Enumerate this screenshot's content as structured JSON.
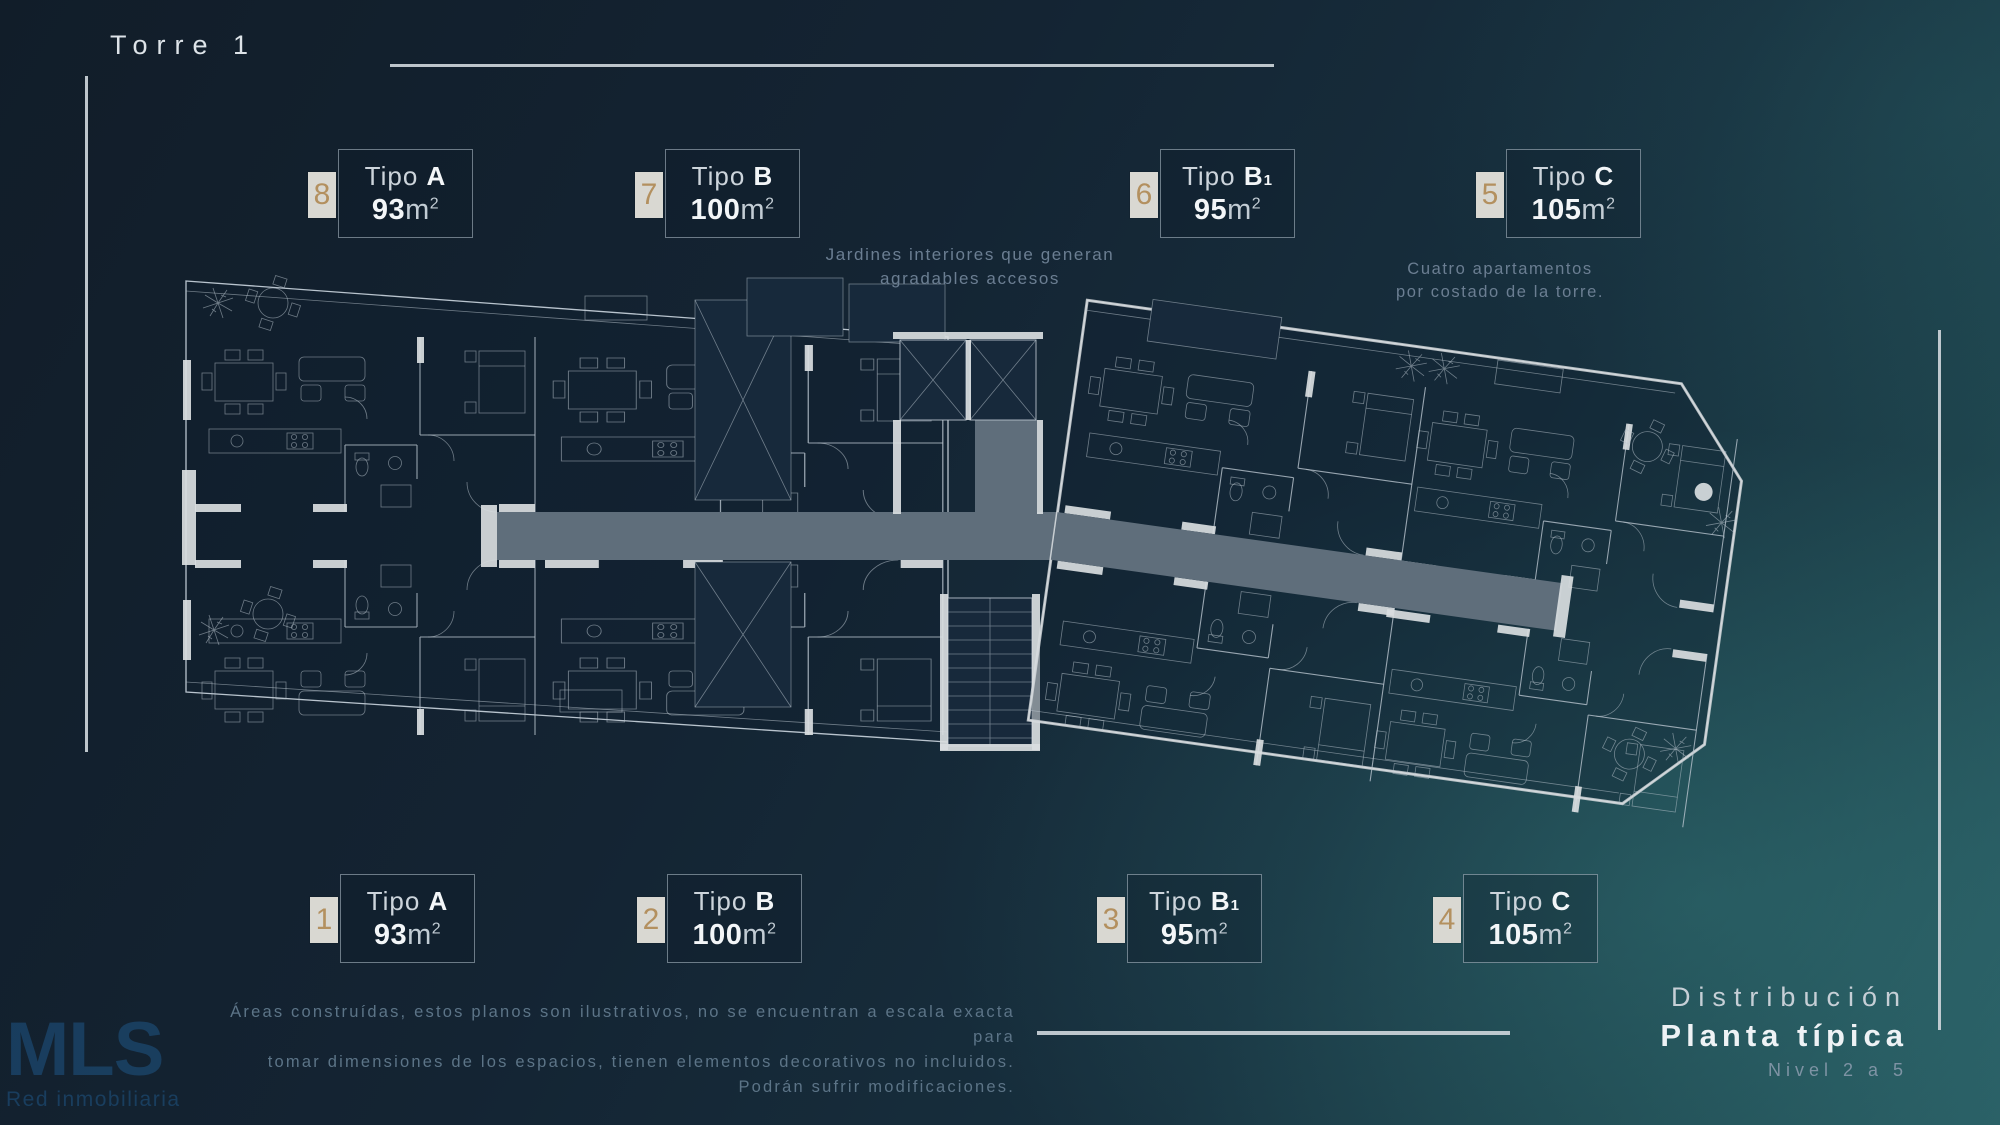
{
  "page": {
    "title": "Torre 1"
  },
  "labels": [
    {
      "number": "8",
      "word": "Tipo",
      "letter": "A",
      "sub": "",
      "area": "93",
      "m_label": "m",
      "sup": "2"
    },
    {
      "number": "7",
      "word": "Tipo",
      "letter": "B",
      "sub": "",
      "area": "100",
      "m_label": "m",
      "sup": "2"
    },
    {
      "number": "6",
      "word": "Tipo",
      "letter": "B",
      "sub": "1",
      "area": "95",
      "m_label": "m",
      "sup": "2"
    },
    {
      "number": "5",
      "word": "Tipo",
      "letter": "C",
      "sub": "",
      "area": "105",
      "m_label": "m",
      "sup": "2"
    },
    {
      "number": "1",
      "word": "Tipo",
      "letter": "A",
      "sub": "",
      "area": "93",
      "m_label": "m",
      "sup": "2"
    },
    {
      "number": "2",
      "word": "Tipo",
      "letter": "B",
      "sub": "",
      "area": "100",
      "m_label": "m",
      "sup": "2"
    },
    {
      "number": "3",
      "word": "Tipo",
      "letter": "B",
      "sub": "1",
      "area": "95",
      "m_label": "m",
      "sup": "2"
    },
    {
      "number": "4",
      "word": "Tipo",
      "letter": "C",
      "sub": "",
      "area": "105",
      "m_label": "m",
      "sup": "2"
    }
  ],
  "annotations": {
    "gardens_line1": "Jardines interiores que generan",
    "gardens_line2": "agradables accesos",
    "side_line1": "Cuatro apartamentos",
    "side_line2": "por costado de la torre."
  },
  "disclaimer": {
    "line1": "Áreas construídas, estos planos son ilustrativos, no se encuentran a escala exacta para",
    "line2": "tomar dimensiones de los espacios, tienen elementos decorativos no incluidos.",
    "line3": "Podrán sufrir modificaciones."
  },
  "footer": {
    "distribution": "Distribución",
    "plan_type": "Planta típica",
    "level": "Nivel 2 a 5"
  },
  "watermark": {
    "logo": "MLS",
    "tagline": "Red inmobiliaria"
  },
  "colors": {
    "background_navy": "#142433",
    "background_teal": "#285a61",
    "corridor_gray": "#5f6e7b",
    "wall_white": "#d9dde0",
    "plan_line": "#b9c4ce",
    "badge_bg": "#d9d8d2",
    "badge_number": "#b3905f",
    "text_light": "#ccd4db",
    "text_bold_white": "#f3f6f8",
    "text_muted": "#6b7e92",
    "watermark_blue": "#1e5585"
  }
}
